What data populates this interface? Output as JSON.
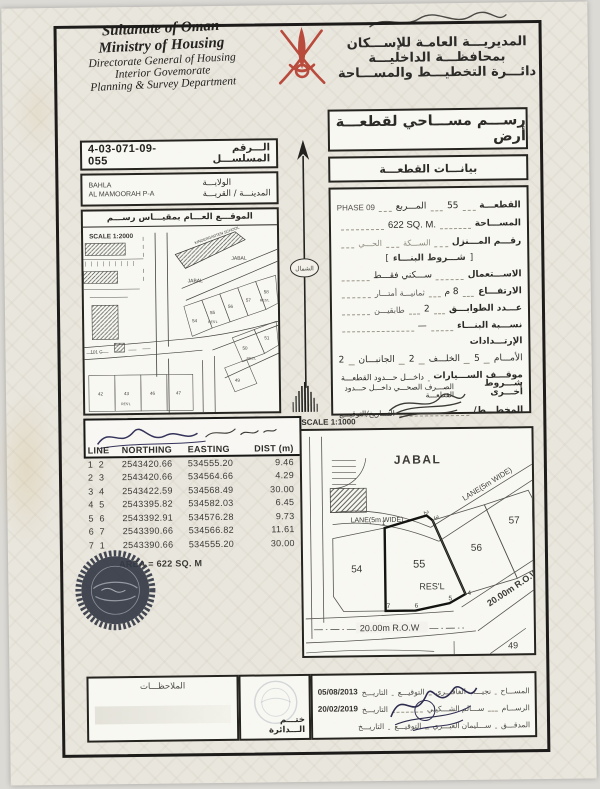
{
  "header": {
    "en": [
      "Sultanate of Oman",
      "Ministry of Housing",
      "Directorate General of Housing",
      "Interior Govemorate",
      "Planning & Survey Department"
    ],
    "ar": [
      "المديريـــة العامـة للإســـكان",
      "بمحافظـــة الداخليـــة",
      "دائـــرة التخطيـــط والمســـاحة"
    ]
  },
  "title_box": "رســـم مســـاحي لقطعـــة أرض",
  "data_box": "بيانـــات القطعـــة",
  "serial": {
    "label": "الـــرقم المسلســـل",
    "value": "4-03-071-09-055"
  },
  "location": {
    "label1": "الولايـــة",
    "label2": "المدينـــة / القريـــة",
    "value1": "BAHLA",
    "value2": "AL MAMOORAH P-A"
  },
  "overview_map": {
    "header": "الموقـــع العـــام بمقيـــاس رســـم",
    "scale": "SCALE 1:2000",
    "labels": {
      "kindergarten": "KINDERGARTEN SCHOOL",
      "jabal1": "JABAL",
      "jabal2": "JABAL",
      "p54": "54",
      "p55": "55",
      "p56": "56",
      "p57": "57",
      "p58": "58",
      "resl1": "RES'L",
      "resl2": "RES'L",
      "resl3": "RES'L",
      "p42": "42",
      "p43": "43",
      "p46": "46",
      "p47": "47",
      "p49": "49",
      "p50": "50",
      "p51": "51",
      "p101": "101 C"
    }
  },
  "north_label": "الشمال",
  "details": {
    "plot_label": "القطعـــة",
    "plot_value": "55",
    "square_label": "المـــربع",
    "square_value": "PHASE 09",
    "area_label": "المســـاحة",
    "area_value": "622 SQ. M.",
    "house_label": "رقـــم المـــنزل",
    "lane_label": "الســـكة",
    "district_label": "الحـــي",
    "conditions_header": "شـــروط البنـــاء",
    "use_label": "الاســـتعمال",
    "use_value": "ســـكني فقـــط",
    "height_label": "الارتفـــاع",
    "height_value": "8 م",
    "height_note": "ثمانيـــة أمتـــار",
    "floors_label": "عـــدد الطوابـــق",
    "floors_value": "2",
    "floors_note": "طابقيـــن",
    "ratio_label": "نســـبة البنـــاء",
    "ratio_value": "—",
    "setbacks_label": "الإرتـــدادات",
    "front_label": "الأمـــام",
    "front_value": "5",
    "back_label": "الخلـــف",
    "back_value": "2",
    "sides_label": "الجانبـــان",
    "sides_value": "2",
    "parking_label": "موقـــف الســـيارات",
    "parking_value": "داخـــل حـــدود القطعـــة",
    "other_label": "شـــروط أخـــرى",
    "other_value": "الصـــرف الصحـــي داخـــل حـــدود القطعـــة",
    "planner_label": "المخطـــط/",
    "planner_date_label": "التـــاريخ/التوقيـــع"
  },
  "detail_map": {
    "scale": "SCALE 1:1000",
    "labels": {
      "jabal": "JABAL",
      "lane1": "LANE(5m WIDE)",
      "lane2": "LANE(5m WIDE)",
      "p54": "54",
      "p55": "55",
      "p56": "56",
      "p57": "57",
      "resl": "RES'L",
      "row1": "20.00m R.O.W",
      "row2": "20.00m R.O.W.",
      "p49": "49",
      "v1": "1",
      "v2": "2",
      "v3": "3",
      "v4": "4",
      "v5": "5",
      "v6": "6",
      "v7": "7"
    }
  },
  "coords_table": {
    "headers": [
      "LINE",
      "NORTHING",
      "EASTING",
      "DIST (m)"
    ],
    "rows": [
      {
        "line": "1  2",
        "northing": "2543420.66",
        "easting": "534555.20",
        "dist": "9.46"
      },
      {
        "line": "2  3",
        "northing": "2543420.66",
        "easting": "534564.66",
        "dist": "4.29"
      },
      {
        "line": "3  4",
        "northing": "2543422.59",
        "easting": "534568.49",
        "dist": "30.00"
      },
      {
        "line": "4  5",
        "northing": "2543395.82",
        "easting": "534582.03",
        "dist": "6.45"
      },
      {
        "line": "5  6",
        "northing": "2543392.91",
        "easting": "534576.28",
        "dist": "9.73"
      },
      {
        "line": "6  7",
        "northing": "2543390.66",
        "easting": "534566.82",
        "dist": "11.61"
      },
      {
        "line": "7  1",
        "northing": "2543390.66",
        "easting": "534555.20",
        "dist": "30.00"
      }
    ],
    "area_line": "AREA = 622 SQ. M"
  },
  "footer": {
    "notes_label": "الملاحظـــات",
    "stamp_label": "ختـــم الـــدائرة",
    "rows": [
      {
        "role": "المســـاح",
        "name": "نجيـــب الغافـــري",
        "sign": "التوقيـــع",
        "date_label": "التاريـــخ",
        "date": "05/08/2013"
      },
      {
        "role": "الرســـام",
        "name": "ســـالم الشـــكيلي",
        "sign": "",
        "date_label": "التاريـــخ",
        "date": "20/02/2019"
      },
      {
        "role": "المدقـــق",
        "name": "ســـليمان العبـــري",
        "sign": "التوقيـــع",
        "date_label": "التاريـــخ",
        "date": ""
      }
    ]
  }
}
